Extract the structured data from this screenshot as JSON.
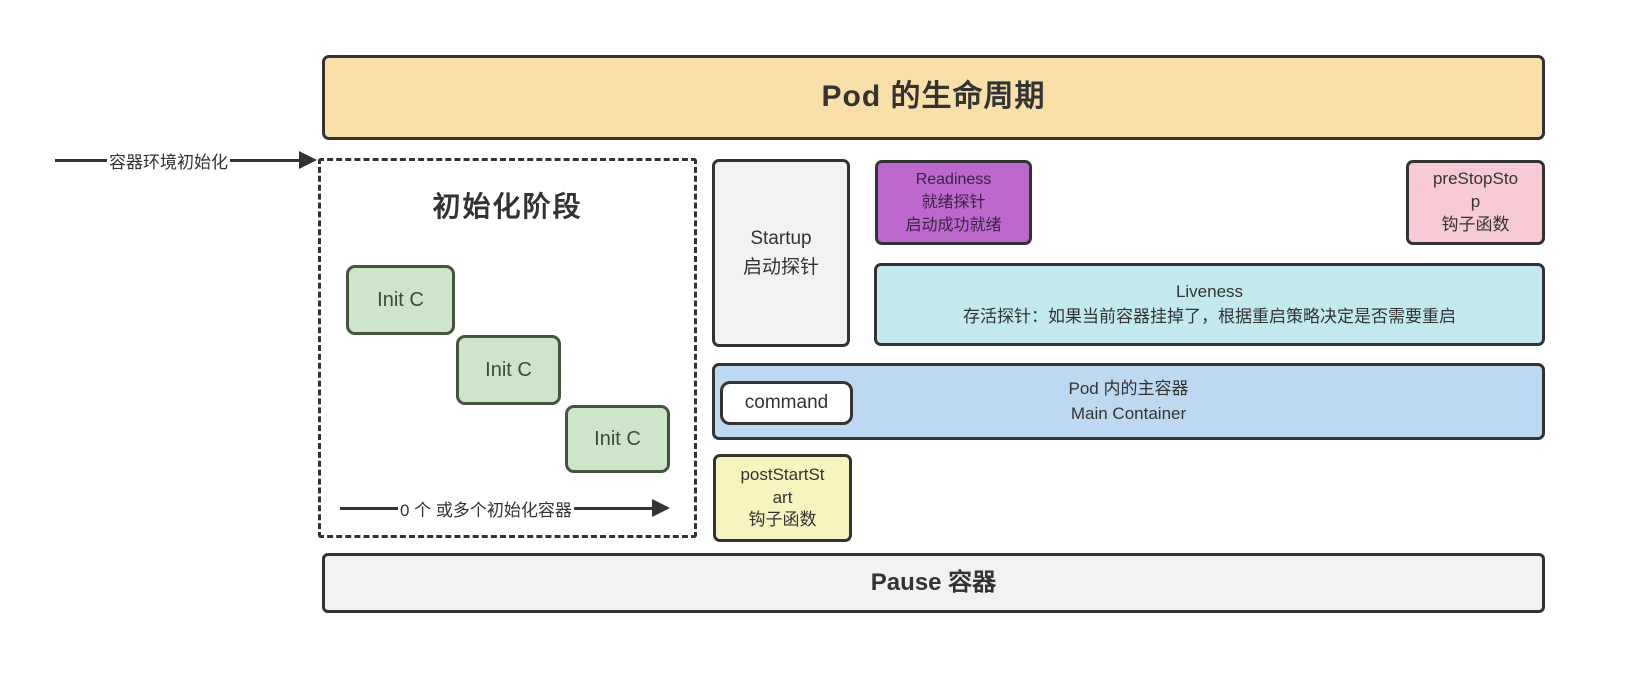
{
  "diagram": {
    "title": "Pod 的生命周期",
    "env_init_arrow_label": "容器环境初始化",
    "init_phase": {
      "title": "初始化阶段",
      "containers": [
        "Init C",
        "Init C",
        "Init C"
      ],
      "bottom_arrow_label": "0 个 或多个初始化容器"
    },
    "startup": {
      "lines": [
        "Startup",
        "启动探针"
      ]
    },
    "readiness": {
      "lines": [
        "Readiness",
        "就绪探针",
        "启动成功就绪"
      ]
    },
    "prestop": {
      "lines": [
        "preStopSto",
        "p",
        "钩子函数"
      ]
    },
    "liveness": {
      "lines": [
        "Liveness",
        "存活探针：如果当前容器挂掉了，根据重启策略决定是否需要重启"
      ]
    },
    "main_container": {
      "lines": [
        "Pod 内的主容器",
        "Main Container"
      ],
      "command_label": "command"
    },
    "poststart": {
      "lines": [
        "postStartSt",
        "art",
        "钩子函数"
      ]
    },
    "pause_label": "Pause 容器",
    "colors": {
      "title_bg": "#F8E0A8",
      "init_container_bg": "#CDE5C9",
      "startup_bg": "#F2F2F2",
      "readiness_bg": "#BC68CC",
      "prestop_bg": "#F8CBD4",
      "liveness_bg": "#C2EAEE",
      "main_container_bg": "#BDD9F1",
      "command_bg": "#FFFFFF",
      "poststart_bg": "#F8F4BE",
      "pause_bg": "#F2F2F2",
      "border": "#333333"
    }
  }
}
